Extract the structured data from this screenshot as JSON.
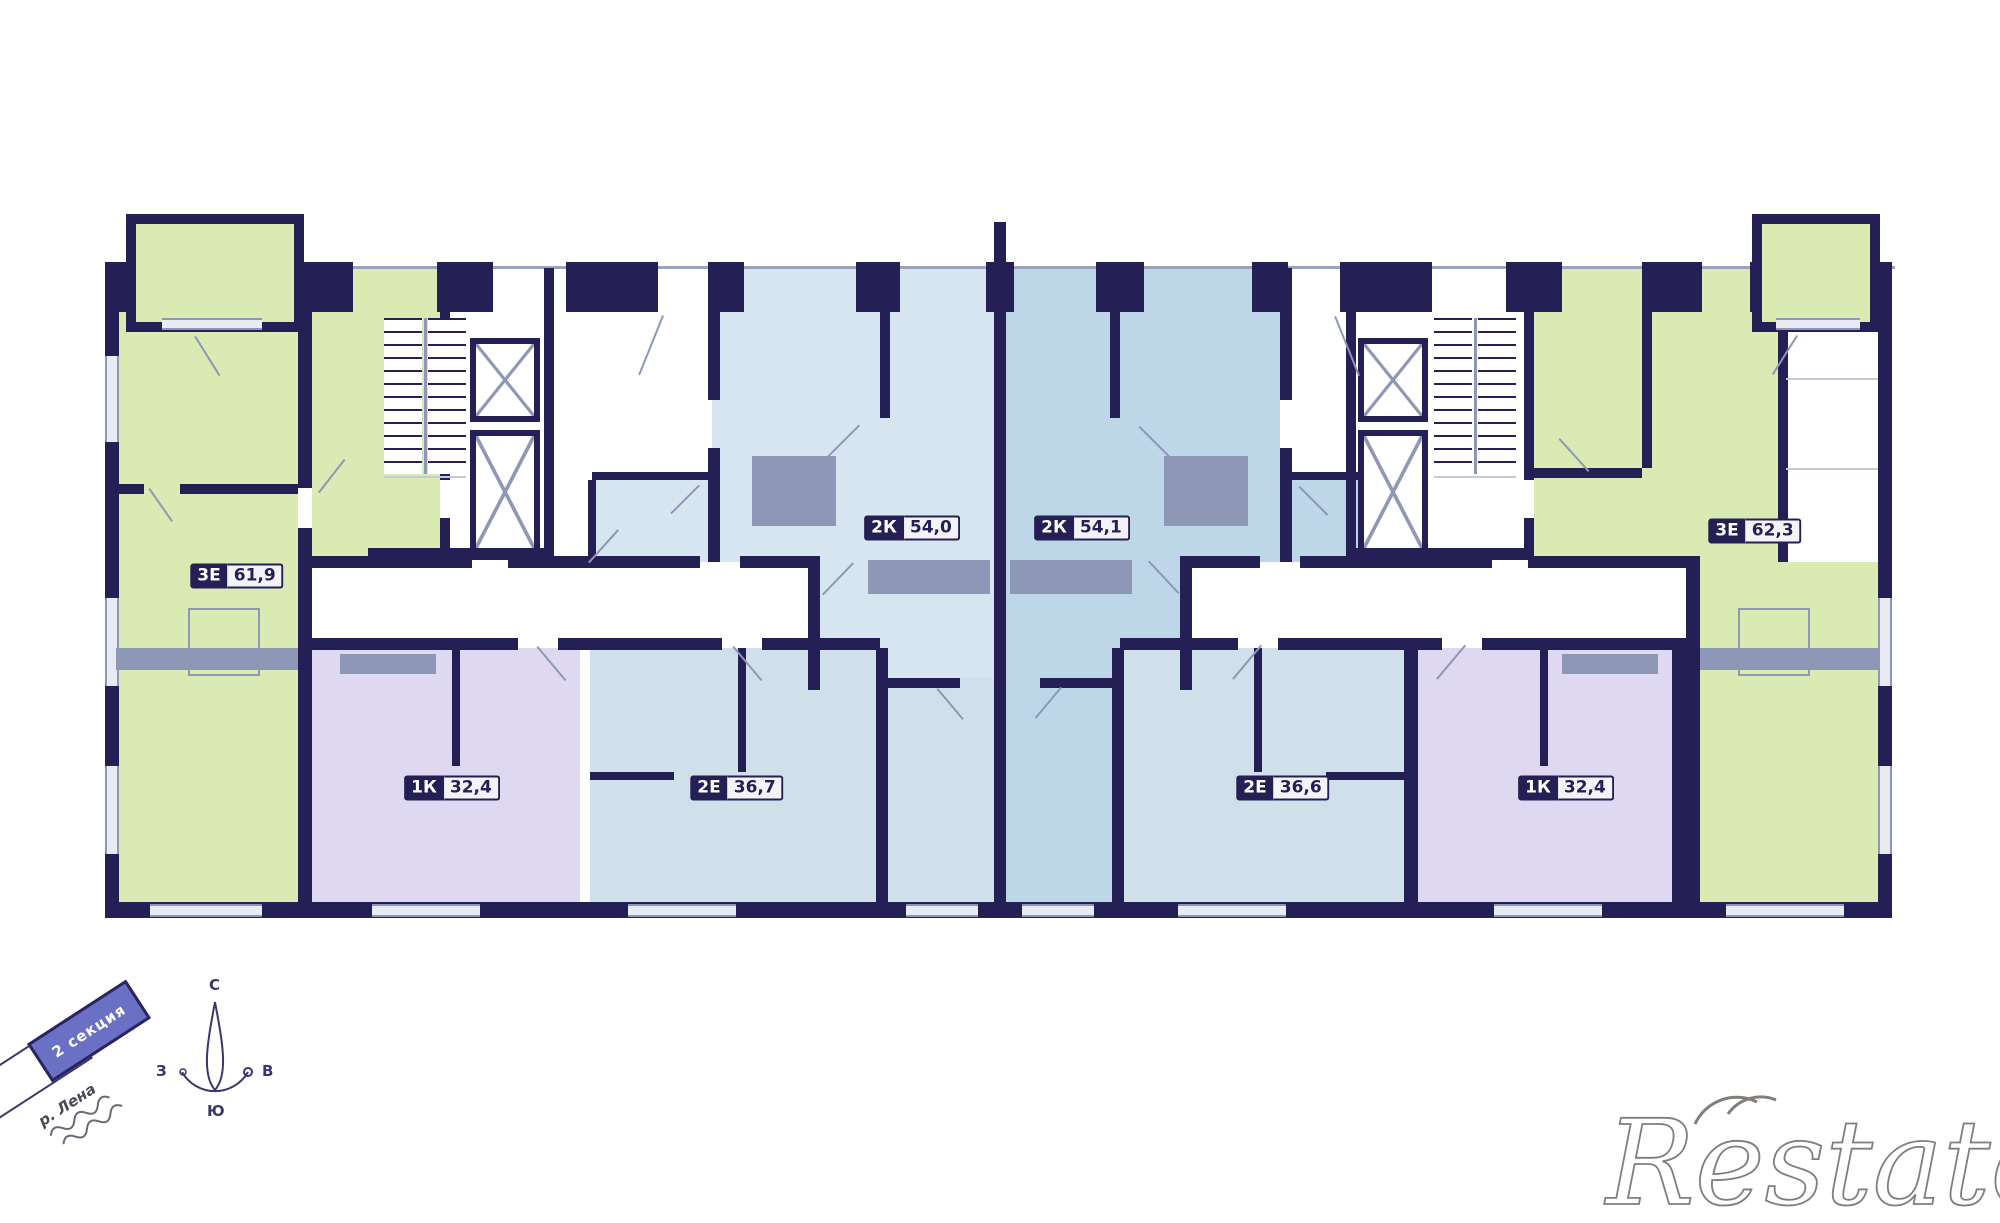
{
  "plan": {
    "wall_color": "#241f55",
    "room_colors": {
      "green": "#d9eab2",
      "blue_light": "#d7e5f0",
      "blue_medium": "#bdd6e8",
      "blue_pale": "#cfe0eb",
      "purple": "#ded8f0",
      "line_gray": "#8e97b6"
    },
    "apartments": [
      {
        "id": "left-3e",
        "type": "3Е",
        "area": "61,9"
      },
      {
        "id": "left-1k",
        "type": "1К",
        "area": "32,4"
      },
      {
        "id": "left-2e",
        "type": "2Е",
        "area": "36,7"
      },
      {
        "id": "center-left-2k",
        "type": "2К",
        "area": "54,0"
      },
      {
        "id": "center-right-2k",
        "type": "2К",
        "area": "54,1"
      },
      {
        "id": "right-2e",
        "type": "2Е",
        "area": "36,6"
      },
      {
        "id": "right-1k",
        "type": "1К",
        "area": "32,4"
      },
      {
        "id": "right-3e",
        "type": "3Е",
        "area": "62,3"
      }
    ]
  },
  "compass": {
    "north": "С",
    "south": "Ю",
    "west": "З",
    "east": "В"
  },
  "annotations": {
    "section_banner": "2 секция",
    "river_label": "р. Лена"
  },
  "watermark": {
    "text": "Restate"
  }
}
